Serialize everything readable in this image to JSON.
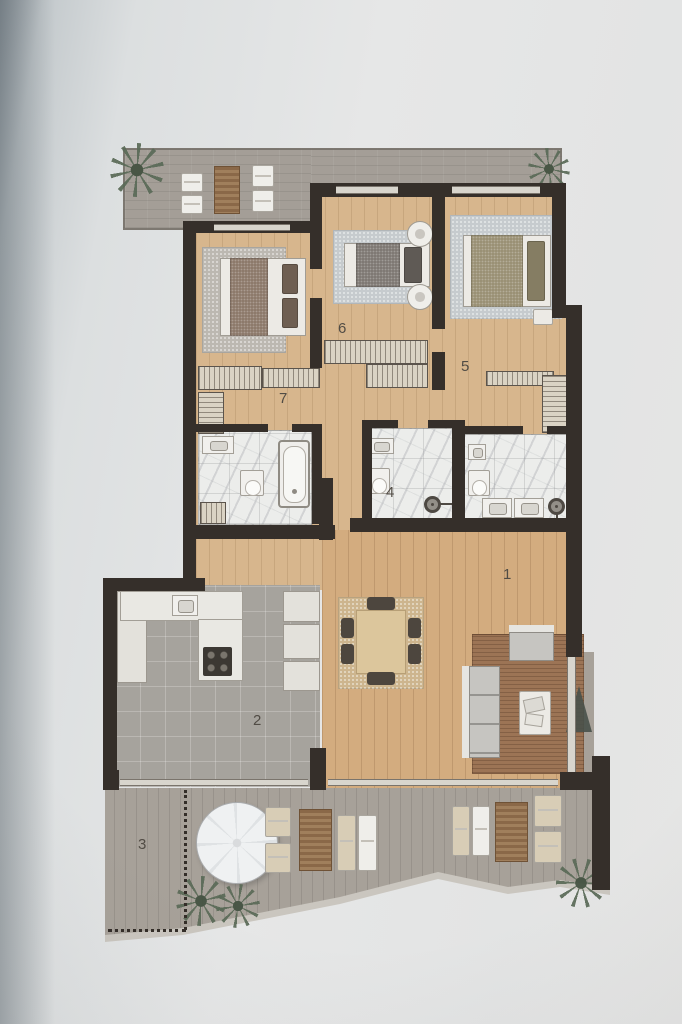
{
  "document": {
    "kind": "apartment-floor-plan",
    "visible_text": [
      "1",
      "2",
      "3",
      "4",
      "5",
      "6",
      "7"
    ]
  },
  "rooms": [
    {
      "number": "1",
      "depicts": "living-dining-room"
    },
    {
      "number": "2",
      "depicts": "kitchen"
    },
    {
      "number": "3",
      "depicts": "lower-terrace"
    },
    {
      "number": "4",
      "depicts": "bathroom"
    },
    {
      "number": "5",
      "depicts": "bedroom-right"
    },
    {
      "number": "6",
      "depicts": "bedroom-middle"
    },
    {
      "number": "7",
      "depicts": "bedroom-left"
    }
  ],
  "icons": [
    "palm-plant",
    "sun-lounger",
    "slatted-outdoor-rug",
    "parasol-umbrella",
    "double-bed",
    "round-pouf",
    "wardrobe",
    "bathtub",
    "toilet",
    "bidet",
    "washbasin",
    "double-washbasin",
    "shower-head",
    "dining-table",
    "dining-chair",
    "sofa",
    "armchair",
    "coffee-table",
    "floor-plant",
    "kitchen-sink",
    "cooktop-hob",
    "refrigerator-column",
    "sliding-glass-door"
  ],
  "colors": {
    "bg": "#e3e4e5",
    "wall": "#352f2a",
    "wood": "#d7b68d",
    "wood-living": "#d3ac7f",
    "tile": "#a6a39d",
    "terrace-top": "#a49e97",
    "terrace-bottom": "#a7a199",
    "terrace-edge": "#cac6bf",
    "marble": "#ecedeb",
    "hatch": "#dad3c4",
    "rug-grey": "#bcb8b1",
    "rug-blue": "#c6cbce",
    "rug-tan": "#cdb58e",
    "rug-brick": "#9c7455",
    "duvet-brown": "#8d7a6b",
    "duvet-grey": "#7f7974",
    "duvet-olive": "#9a9175",
    "pillow-dark": "#6f5f52",
    "white-furn": "#eceae5",
    "sofa": "#c6c5c1",
    "counter": "#e9e8e3",
    "appliance": "#e3e1db",
    "fixture-dark": "#3c3833",
    "plant": "#5a6a57",
    "plant-dark": "#49514a",
    "label": "#514c45",
    "umbrella": "#eff1f2",
    "glazing": "#d8d5cd"
  }
}
